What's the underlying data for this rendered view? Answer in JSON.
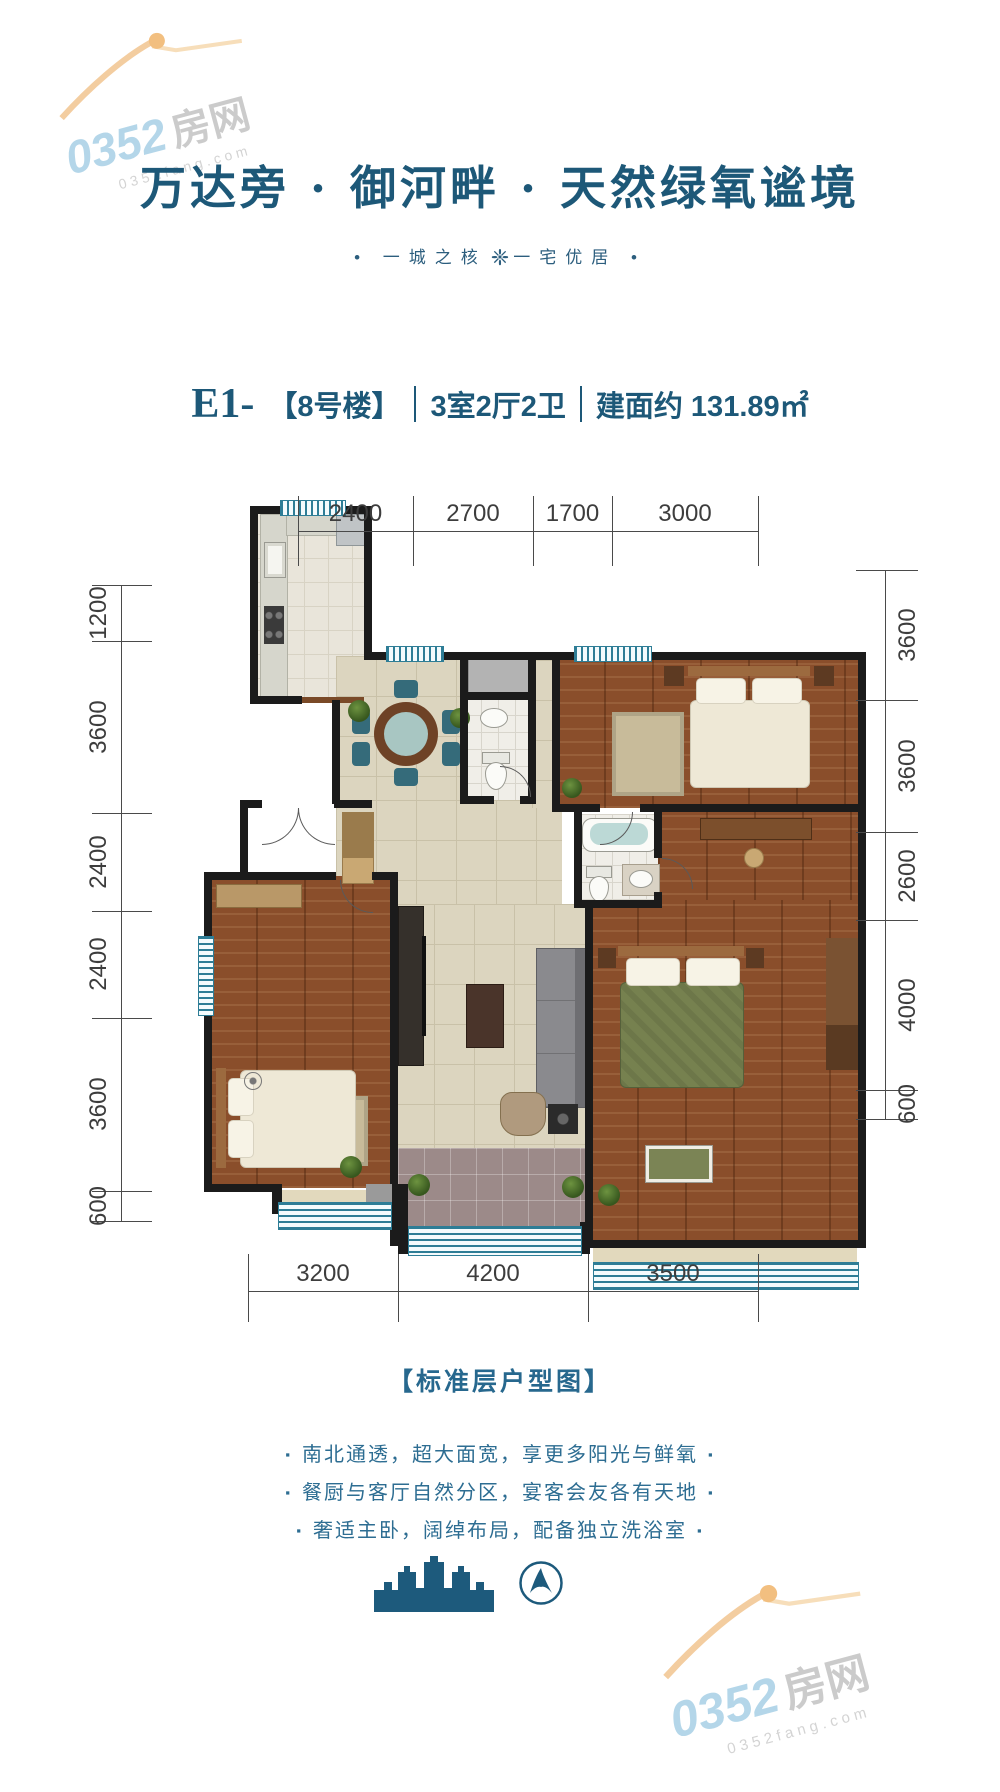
{
  "watermark": {
    "number": "0352",
    "suffix": "房网",
    "domain": "0352fang.com"
  },
  "header": {
    "title": "万达旁 · 御河畔 · 天然绿氧谧境",
    "subtitle_dot": "•",
    "subtitle_left": "一城之核",
    "subtitle_ornament": "❈",
    "subtitle_right": "一宅优居"
  },
  "unit": {
    "code": "E1-",
    "building": "【8号楼】",
    "layout": "3室2厅2卫",
    "area": "建面约 131.89㎡"
  },
  "dimensions": {
    "top": [
      "2400",
      "2700",
      "1700",
      "3000"
    ],
    "left": [
      "1200",
      "3600",
      "2400",
      "2400",
      "3600",
      "600"
    ],
    "right": [
      "3600",
      "3600",
      "2600",
      "4000",
      "600"
    ],
    "bottom": [
      "3200",
      "4200",
      "3500"
    ]
  },
  "footer": {
    "plan_label": "【标准层户型图】",
    "bullet_marker": "▪",
    "bullets": [
      "南北通透，超大面宽，享更多阳光与鲜氧",
      "餐厨与客厅自然分区，宴客会友各有天地",
      "奢适主卧，阔绰布局，配备独立洗浴室"
    ]
  },
  "colors": {
    "brand_teal": "#1d5a7c",
    "text_blue": "#2d6d92",
    "dim_gray": "#3d3d3d",
    "wall_black": "#1b1b1b",
    "window_teal": "#2e7d96",
    "watermark_orange": "#f2c590"
  }
}
